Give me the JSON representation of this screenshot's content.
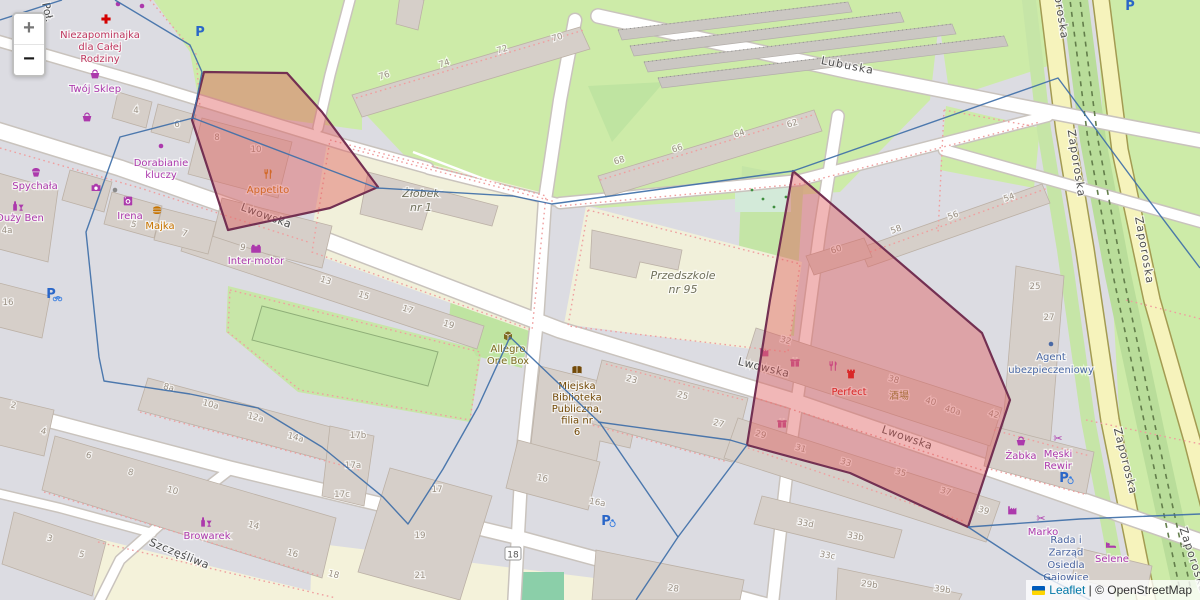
{
  "controls": {
    "zoom_in_label": "+",
    "zoom_out_label": "−"
  },
  "attribution": {
    "leaflet_link": "Leaflet",
    "separator": " | ",
    "osm_text": "© OpenStreetMap"
  },
  "colors": {
    "overlay_fill": "#e05c5c",
    "overlay_stroke": "#733052",
    "boundary_blue": "#3f6fa8",
    "shop_purple": "#ac39ac",
    "food_orange": "#c77400",
    "civic_brown": "#734a08",
    "office_blue": "#4a69a5",
    "health_red": "#c0385f",
    "school_gray": "#70705c",
    "note_blue": "#4863a0",
    "poi_red": "#d40000",
    "magenta": "#bb4a90",
    "parking_blue": "#2a66c8",
    "cjk_olive": "#7c7c24"
  },
  "street_labels": [
    {
      "text": "Poł.",
      "x": 44,
      "y": 13,
      "rot": 78,
      "sp": 0
    },
    {
      "text": "Lwowska",
      "x": 265,
      "y": 219,
      "rot": 20,
      "sp": 0.5
    },
    {
      "text": "Lwowska",
      "x": 763,
      "y": 371,
      "rot": 14,
      "sp": 0.5
    },
    {
      "text": "Lwowska",
      "x": 906,
      "y": 441,
      "rot": 19,
      "sp": 0.5
    },
    {
      "text": "Szczęśliwa",
      "x": 178,
      "y": 557,
      "rot": 22,
      "sp": 0.5
    },
    {
      "text": "Lubuska",
      "x": 847,
      "y": 69,
      "rot": 11,
      "sp": 1.2
    },
    {
      "text": "Zaporoska",
      "x": 1056,
      "y": 6,
      "rot": 81,
      "sp": 1.2
    },
    {
      "text": "Zaporoska",
      "x": 1073,
      "y": 164,
      "rot": 81,
      "sp": 1.2
    },
    {
      "text": "Zaporoska",
      "x": 1141,
      "y": 251,
      "rot": 80,
      "sp": 1.2
    },
    {
      "text": "Zaporoska",
      "x": 1122,
      "y": 462,
      "rot": 76,
      "sp": 1.2
    },
    {
      "text": "Zaporoska",
      "x": 1190,
      "y": 561,
      "rot": 72,
      "sp": 1.2
    }
  ],
  "house_numbers": [
    {
      "t": "4",
      "x": 136,
      "y": 113,
      "r": 0
    },
    {
      "t": "6",
      "x": 177,
      "y": 127,
      "r": 0
    },
    {
      "t": "8",
      "x": 217,
      "y": 140,
      "r": 0
    },
    {
      "t": "10",
      "x": 256,
      "y": 152,
      "r": 0
    },
    {
      "t": "76",
      "x": 385,
      "y": 78,
      "r": -17
    },
    {
      "t": "74",
      "x": 445,
      "y": 66,
      "r": -17
    },
    {
      "t": "72",
      "x": 503,
      "y": 52,
      "r": -17
    },
    {
      "t": "70",
      "x": 558,
      "y": 40,
      "r": -17
    },
    {
      "t": "68",
      "x": 620,
      "y": 163,
      "r": -17
    },
    {
      "t": "66",
      "x": 678,
      "y": 151,
      "r": -17
    },
    {
      "t": "64",
      "x": 740,
      "y": 136,
      "r": -17
    },
    {
      "t": "62",
      "x": 793,
      "y": 126,
      "r": -17
    },
    {
      "t": "58",
      "x": 897,
      "y": 232,
      "r": -20
    },
    {
      "t": "56",
      "x": 954,
      "y": 218,
      "r": -20
    },
    {
      "t": "54",
      "x": 1010,
      "y": 200,
      "r": -20
    },
    {
      "t": "60",
      "x": 837,
      "y": 252,
      "r": -18
    },
    {
      "t": "25",
      "x": 1035,
      "y": 289,
      "r": 0
    },
    {
      "t": "27",
      "x": 1049,
      "y": 320,
      "r": 0
    },
    {
      "t": "2",
      "x": 13,
      "y": 408,
      "r": 12
    },
    {
      "t": "4",
      "x": 43,
      "y": 434,
      "r": 12
    },
    {
      "t": "4a",
      "x": 7,
      "y": 233,
      "r": 0
    },
    {
      "t": "16",
      "x": 8,
      "y": 305,
      "r": 0
    },
    {
      "t": "5",
      "x": 133,
      "y": 227,
      "r": 15
    },
    {
      "t": "7",
      "x": 184,
      "y": 236,
      "r": 15
    },
    {
      "t": "9",
      "x": 242,
      "y": 250,
      "r": 15
    },
    {
      "t": "13",
      "x": 325,
      "y": 283,
      "r": 17
    },
    {
      "t": "15",
      "x": 363,
      "y": 298,
      "r": 17
    },
    {
      "t": "17",
      "x": 407,
      "y": 312,
      "r": 17
    },
    {
      "t": "19",
      "x": 448,
      "y": 327,
      "r": 17
    },
    {
      "t": "8a",
      "x": 168,
      "y": 390,
      "r": 15
    },
    {
      "t": "10a",
      "x": 210,
      "y": 407,
      "r": 15
    },
    {
      "t": "12a",
      "x": 255,
      "y": 420,
      "r": 15
    },
    {
      "t": "14a",
      "x": 295,
      "y": 440,
      "r": 15
    },
    {
      "t": "17b",
      "x": 358,
      "y": 438,
      "r": 0
    },
    {
      "t": "17a",
      "x": 353,
      "y": 468,
      "r": 0
    },
    {
      "t": "17c",
      "x": 342,
      "y": 497,
      "r": 0
    },
    {
      "t": "6",
      "x": 88,
      "y": 458,
      "r": 15
    },
    {
      "t": "8",
      "x": 130,
      "y": 475,
      "r": 15
    },
    {
      "t": "10",
      "x": 172,
      "y": 493,
      "r": 15
    },
    {
      "t": "14",
      "x": 253,
      "y": 528,
      "r": 15
    },
    {
      "t": "16",
      "x": 292,
      "y": 556,
      "r": 15
    },
    {
      "t": "18",
      "x": 333,
      "y": 577,
      "r": 15
    },
    {
      "t": "3",
      "x": 49,
      "y": 541,
      "r": 15
    },
    {
      "t": "5",
      "x": 81,
      "y": 557,
      "r": 15
    },
    {
      "t": "23",
      "x": 631,
      "y": 382,
      "r": 15
    },
    {
      "t": "25",
      "x": 682,
      "y": 398,
      "r": 15
    },
    {
      "t": "27",
      "x": 718,
      "y": 426,
      "r": 15
    },
    {
      "t": "16",
      "x": 542,
      "y": 481,
      "r": 10
    },
    {
      "t": "16a",
      "x": 597,
      "y": 505,
      "r": 10
    },
    {
      "t": "18",
      "x": 513,
      "y": 556,
      "r": 0,
      "boxed": true
    },
    {
      "t": "28",
      "x": 673,
      "y": 591,
      "r": 8
    },
    {
      "t": "17",
      "x": 437,
      "y": 492,
      "r": 0
    },
    {
      "t": "19",
      "x": 420,
      "y": 538,
      "r": 0
    },
    {
      "t": "21",
      "x": 420,
      "y": 578,
      "r": 0
    },
    {
      "t": "33d",
      "x": 805,
      "y": 526,
      "r": 10
    },
    {
      "t": "33b",
      "x": 855,
      "y": 539,
      "r": 10
    },
    {
      "t": "33c",
      "x": 827,
      "y": 558,
      "r": 10
    },
    {
      "t": "29b",
      "x": 869,
      "y": 587,
      "r": 8
    },
    {
      "t": "39b",
      "x": 942,
      "y": 592,
      "r": 8
    },
    {
      "t": "32",
      "x": 785,
      "y": 343,
      "r": 16
    },
    {
      "t": "38",
      "x": 893,
      "y": 382,
      "r": 16
    },
    {
      "t": "40",
      "x": 930,
      "y": 404,
      "r": 16
    },
    {
      "t": "40a",
      "x": 952,
      "y": 413,
      "r": 16
    },
    {
      "t": "42",
      "x": 993,
      "y": 417,
      "r": 16
    },
    {
      "t": "29",
      "x": 760,
      "y": 437,
      "r": 16
    },
    {
      "t": "31",
      "x": 800,
      "y": 451,
      "r": 16
    },
    {
      "t": "33",
      "x": 845,
      "y": 465,
      "r": 16
    },
    {
      "t": "35",
      "x": 900,
      "y": 475,
      "r": 16
    },
    {
      "t": "37",
      "x": 945,
      "y": 494,
      "r": 16
    },
    {
      "t": "39",
      "x": 983,
      "y": 513,
      "r": 16
    }
  ],
  "pois": [
    {
      "id": "niezapominajka",
      "lines": [
        "Niezapominajka",
        "dla Całej",
        "Rodziny"
      ],
      "x": 100,
      "y": 38,
      "lh": 12,
      "cls": "health",
      "icon": "pharmacy-cross-icon",
      "ix": 106,
      "iy": 19,
      "ic": "#d40000"
    },
    {
      "id": "twoj-sklep",
      "lines": [
        "Twój Sklep"
      ],
      "x": 95,
      "y": 92,
      "lh": 12,
      "cls": "shop",
      "icon": "basket-icon",
      "ix": 95,
      "iy": 74,
      "ic": "#ac39ac"
    },
    {
      "id": "dorabianie-kluczy",
      "lines": [
        "Dorabianie",
        "kluczy"
      ],
      "x": 161,
      "y": 166,
      "lh": 12,
      "cls": "shop",
      "icon": "dot-icon",
      "ix": 161,
      "iy": 146,
      "ic": "#ac39ac"
    },
    {
      "id": "spychala",
      "lines": [
        "Spychała"
      ],
      "x": 35,
      "y": 189,
      "lh": 12,
      "cls": "shop",
      "icon": "cupcake-icon",
      "ix": 36,
      "iy": 172,
      "ic": "#ac39ac"
    },
    {
      "id": "duzy-ben",
      "lines": [
        "Duży Ben"
      ],
      "x": 20,
      "y": 221,
      "lh": 12,
      "cls": "shop",
      "icon": "bottle-glass-icon",
      "ix": 18,
      "iy": 206,
      "ic": "#ac39ac"
    },
    {
      "id": "irena",
      "lines": [
        "Irena"
      ],
      "x": 130,
      "y": 219,
      "lh": 12,
      "cls": "shop",
      "icon": "washer-icon",
      "ix": 128,
      "iy": 201,
      "ic": "#ac39ac"
    },
    {
      "id": "majka",
      "lines": [
        "Majka"
      ],
      "x": 160,
      "y": 229,
      "lh": 12,
      "cls": "food",
      "icon": "burger-icon",
      "ix": 157,
      "iy": 211,
      "ic": "#c77400"
    },
    {
      "id": "inter-motor",
      "lines": [
        "Inter-motor"
      ],
      "x": 256,
      "y": 264,
      "lh": 12,
      "cls": "shop",
      "icon": "battery-icon",
      "ix": 256,
      "iy": 249,
      "ic": "#ac39ac"
    },
    {
      "id": "appetito",
      "lines": [
        "Appetito"
      ],
      "x": 268,
      "y": 193,
      "lh": 12,
      "cls": "food",
      "icon": "fork-knife-icon",
      "ix": 268,
      "iy": 174,
      "ic": "#c77400"
    },
    {
      "id": "allegro-one-box",
      "lines": [
        "Allegro",
        "One Box"
      ],
      "x": 508,
      "y": 352,
      "lh": 12,
      "cls": "locker",
      "icon": "parcel-box-icon",
      "ix": 508,
      "iy": 336,
      "ic": "#7d6a1f"
    },
    {
      "id": "biblioteka",
      "lines": [
        "Miejska",
        "Biblioteka",
        "Publiczna,",
        "filia nr",
        "6"
      ],
      "x": 577,
      "y": 389,
      "lh": 11.5,
      "cls": "civic",
      "icon": "book-icon",
      "ix": 577,
      "iy": 370,
      "ic": "#734a08"
    },
    {
      "id": "zlobek",
      "lines": [
        "Żłobek",
        "nr 1"
      ],
      "x": 421,
      "y": 197,
      "lh": 14,
      "cls": "school"
    },
    {
      "id": "przedszkole",
      "lines": [
        "Przedszkole",
        "nr 95"
      ],
      "x": 683,
      "y": 279,
      "lh": 14,
      "cls": "school"
    },
    {
      "id": "perfect",
      "lines": [
        "Perfect"
      ],
      "x": 849,
      "y": 395,
      "lh": 12,
      "cls": "red",
      "icon": "castle-icon",
      "ix": 851,
      "iy": 374,
      "ic": "#d40000"
    },
    {
      "id": "izakaya",
      "lines": [
        "酒場"
      ],
      "x": 899,
      "y": 399,
      "lh": 10,
      "cls": "cjk"
    },
    {
      "id": "zabka",
      "lines": [
        "Żabka"
      ],
      "x": 1021,
      "y": 459,
      "lh": 12,
      "cls": "shop",
      "icon": "basket-icon",
      "ix": 1021,
      "iy": 441,
      "ic": "#ac39ac"
    },
    {
      "id": "meski-rewir",
      "lines": [
        "Męski",
        "Rewir"
      ],
      "x": 1058,
      "y": 457,
      "lh": 12,
      "cls": "shop",
      "icon": "scissors-icon",
      "ix": 1058,
      "iy": 438,
      "ic": "#ac39ac"
    },
    {
      "id": "marko",
      "lines": [
        "Marko"
      ],
      "x": 1043,
      "y": 535,
      "lh": 12,
      "cls": "shop",
      "icon": "scissors-icon",
      "ix": 1041,
      "iy": 518,
      "ic": "#ac39ac"
    },
    {
      "id": "rada-osiedla",
      "lines": [
        "Rada i",
        "Zarząd",
        "Osiedla",
        "Gajowice"
      ],
      "x": 1066,
      "y": 543,
      "lh": 12.5,
      "cls": "note"
    },
    {
      "id": "selene",
      "lines": [
        "Selene"
      ],
      "x": 1112,
      "y": 562,
      "lh": 12,
      "cls": "shop",
      "icon": "bed-icon",
      "ix": 1111,
      "iy": 545,
      "ic": "#ac39ac"
    },
    {
      "id": "agent-ubezp",
      "lines": [
        "Agent",
        "ubezpieczeniowy"
      ],
      "x": 1051,
      "y": 360,
      "lh": 13,
      "cls": "office",
      "icon": "dot-icon",
      "ix": 1051,
      "iy": 344,
      "ic": "#4a69a5"
    },
    {
      "id": "browarek",
      "lines": [
        "Browarek"
      ],
      "x": 207,
      "y": 539,
      "lh": 12,
      "cls": "shop",
      "icon": "bottle-glass-icon",
      "ix": 206,
      "iy": 522,
      "ic": "#ac39ac"
    }
  ],
  "extra_icons": [
    {
      "icon": "basket-icon",
      "x": 87,
      "y": 117,
      "c": "#ac39ac"
    },
    {
      "icon": "camera-icon",
      "x": 96,
      "y": 188,
      "c": "#ac39ac"
    },
    {
      "icon": "dot-icon",
      "x": 118,
      "y": 4,
      "c": "#ac39ac"
    },
    {
      "icon": "dot-icon",
      "x": 142,
      "y": 6,
      "c": "#ac39ac"
    },
    {
      "icon": "dot-icon",
      "x": 115,
      "y": 190,
      "c": "#8a8a8a"
    },
    {
      "icon": "factory-icon",
      "x": 765,
      "y": 352,
      "c": "#bb4a90"
    },
    {
      "icon": "gift-icon",
      "x": 795,
      "y": 362,
      "c": "#bb4a90"
    },
    {
      "icon": "fork-knife-icon",
      "x": 833,
      "y": 366,
      "c": "#bb3d9c"
    },
    {
      "icon": "gift-icon",
      "x": 782,
      "y": 423,
      "c": "#bb4a90"
    },
    {
      "icon": "factory-icon",
      "x": 1013,
      "y": 510,
      "c": "#ac39ac"
    },
    {
      "icon": "green-dot-icon",
      "x": 752,
      "y": 190,
      "c": "#3f8f3f"
    },
    {
      "icon": "green-dot-icon",
      "x": 763,
      "y": 199,
      "c": "#3f8f3f"
    },
    {
      "icon": "green-dot-icon",
      "x": 774,
      "y": 207,
      "c": "#3f8f3f"
    },
    {
      "icon": "green-dot-icon",
      "x": 786,
      "y": 197,
      "c": "#3f8f3f"
    }
  ],
  "parking_markers": [
    {
      "x": 200,
      "y": 32,
      "variant": "plain"
    },
    {
      "x": 1130,
      "y": 6,
      "variant": "plain"
    },
    {
      "x": 606,
      "y": 521,
      "variant": "wheelchair"
    },
    {
      "x": 1064,
      "y": 478,
      "variant": "wheelchair"
    },
    {
      "x": 51,
      "y": 294,
      "variant": "bicycle"
    }
  ],
  "overlays": {
    "regions": [
      {
        "id": "highlight-region-west",
        "points": [
          [
            204,
            72
          ],
          [
            287,
            73
          ],
          [
            322,
            112
          ],
          [
            378,
            187
          ],
          [
            330,
            208
          ],
          [
            228,
            230
          ],
          [
            192,
            120
          ]
        ]
      },
      {
        "id": "highlight-region-east",
        "points": [
          [
            793,
            171
          ],
          [
            982,
            333
          ],
          [
            1010,
            400
          ],
          [
            968,
            527
          ],
          [
            850,
            473
          ],
          [
            747,
            445
          ],
          [
            770,
            300
          ]
        ]
      }
    ],
    "boundary_lines": [
      [
        [
          0,
          20
        ],
        [
          62,
          0
        ]
      ],
      [
        [
          115,
          0
        ],
        [
          190,
          45
        ],
        [
          202,
          72
        ],
        [
          193,
          118
        ],
        [
          377,
          188
        ],
        [
          513,
          196
        ],
        [
          552,
          204
        ],
        [
          793,
          171
        ],
        [
          1058,
          78
        ],
        [
          1132,
          178
        ],
        [
          1200,
          268
        ]
      ],
      [
        [
          193,
          118
        ],
        [
          120,
          137
        ],
        [
          86,
          232
        ],
        [
          99,
          357
        ],
        [
          104,
          381
        ],
        [
          190,
          394
        ],
        [
          258,
          408
        ],
        [
          322,
          447
        ],
        [
          383,
          497
        ],
        [
          408,
          524
        ],
        [
          443,
          469
        ],
        [
          478,
          407
        ],
        [
          510,
          337
        ],
        [
          600,
          423
        ],
        [
          678,
          537
        ],
        [
          636,
          600
        ]
      ],
      [
        [
          598,
          422
        ],
        [
          730,
          440
        ],
        [
          747,
          445
        ]
      ],
      [
        [
          747,
          445
        ],
        [
          678,
          537
        ]
      ],
      [
        [
          968,
          527
        ],
        [
          1080,
          519
        ],
        [
          1200,
          514
        ]
      ],
      [
        [
          968,
          527
        ],
        [
          1040,
          574
        ],
        [
          1090,
          600
        ]
      ]
    ]
  }
}
